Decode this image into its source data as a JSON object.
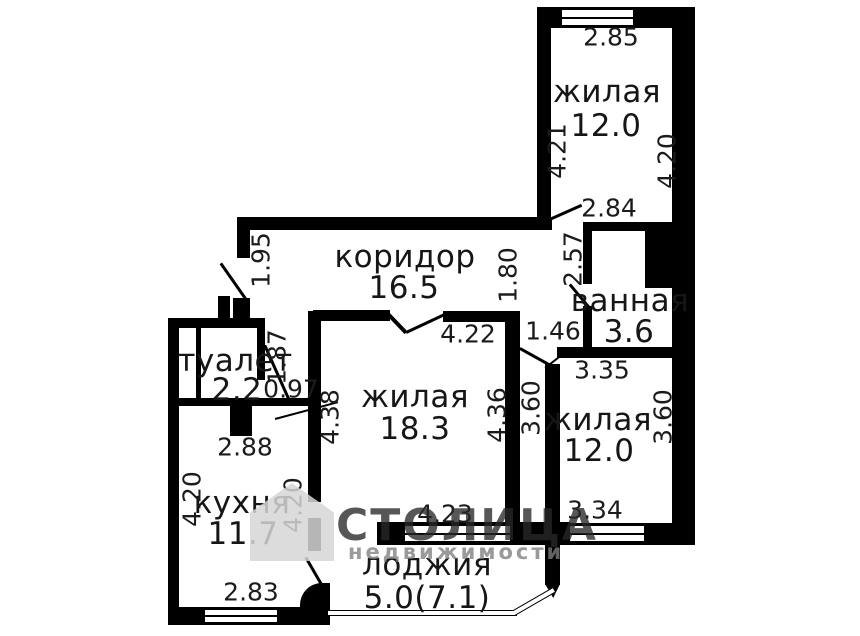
{
  "rooms": {
    "top": {
      "name": "жилая",
      "area": "12.0"
    },
    "corridor": {
      "name": "коридор",
      "area": "16.5"
    },
    "bathroom": {
      "name": "ванная",
      "area": "3.6"
    },
    "toilet": {
      "name": "туалет",
      "area": "2.2"
    },
    "center": {
      "name": "жилая",
      "area": "18.3"
    },
    "right": {
      "name": "жилая",
      "area": "12.0"
    },
    "kitchen": {
      "name": "кухня",
      "area": "11.7"
    },
    "loggia": {
      "name": "лоджия",
      "area": "5.0(7.1)"
    }
  },
  "dims": {
    "top_width": "2.85",
    "top_left": "4.21",
    "top_right": "4.20",
    "top_door": "2.84",
    "corr_left": "1.95",
    "corr_right": "1.80",
    "bath_left": "2.57",
    "bath_pass": "1.46",
    "bath_bottom": "3.35",
    "toilet_right": "1.87",
    "toilet_door": "0.97",
    "toilet_bottom": "2.88",
    "center_top": "4.22",
    "center_left": "4.38",
    "center_right": "4.36",
    "center_bottom": "4.23",
    "right_left": "3.60",
    "right_right": "3.60",
    "right_bottom": "3.34",
    "kitchen_left": "4.20",
    "kitchen_right": "4.20",
    "kitchen_bottom": "2.83"
  },
  "watermark": {
    "line1": "СТОЛИЦА",
    "line2": "недвижимости"
  },
  "colors": {
    "wall": "#000000",
    "background": "#ffffff",
    "dimension_text": "#1b1b1b",
    "watermark_gray": "#d6d6d6"
  }
}
